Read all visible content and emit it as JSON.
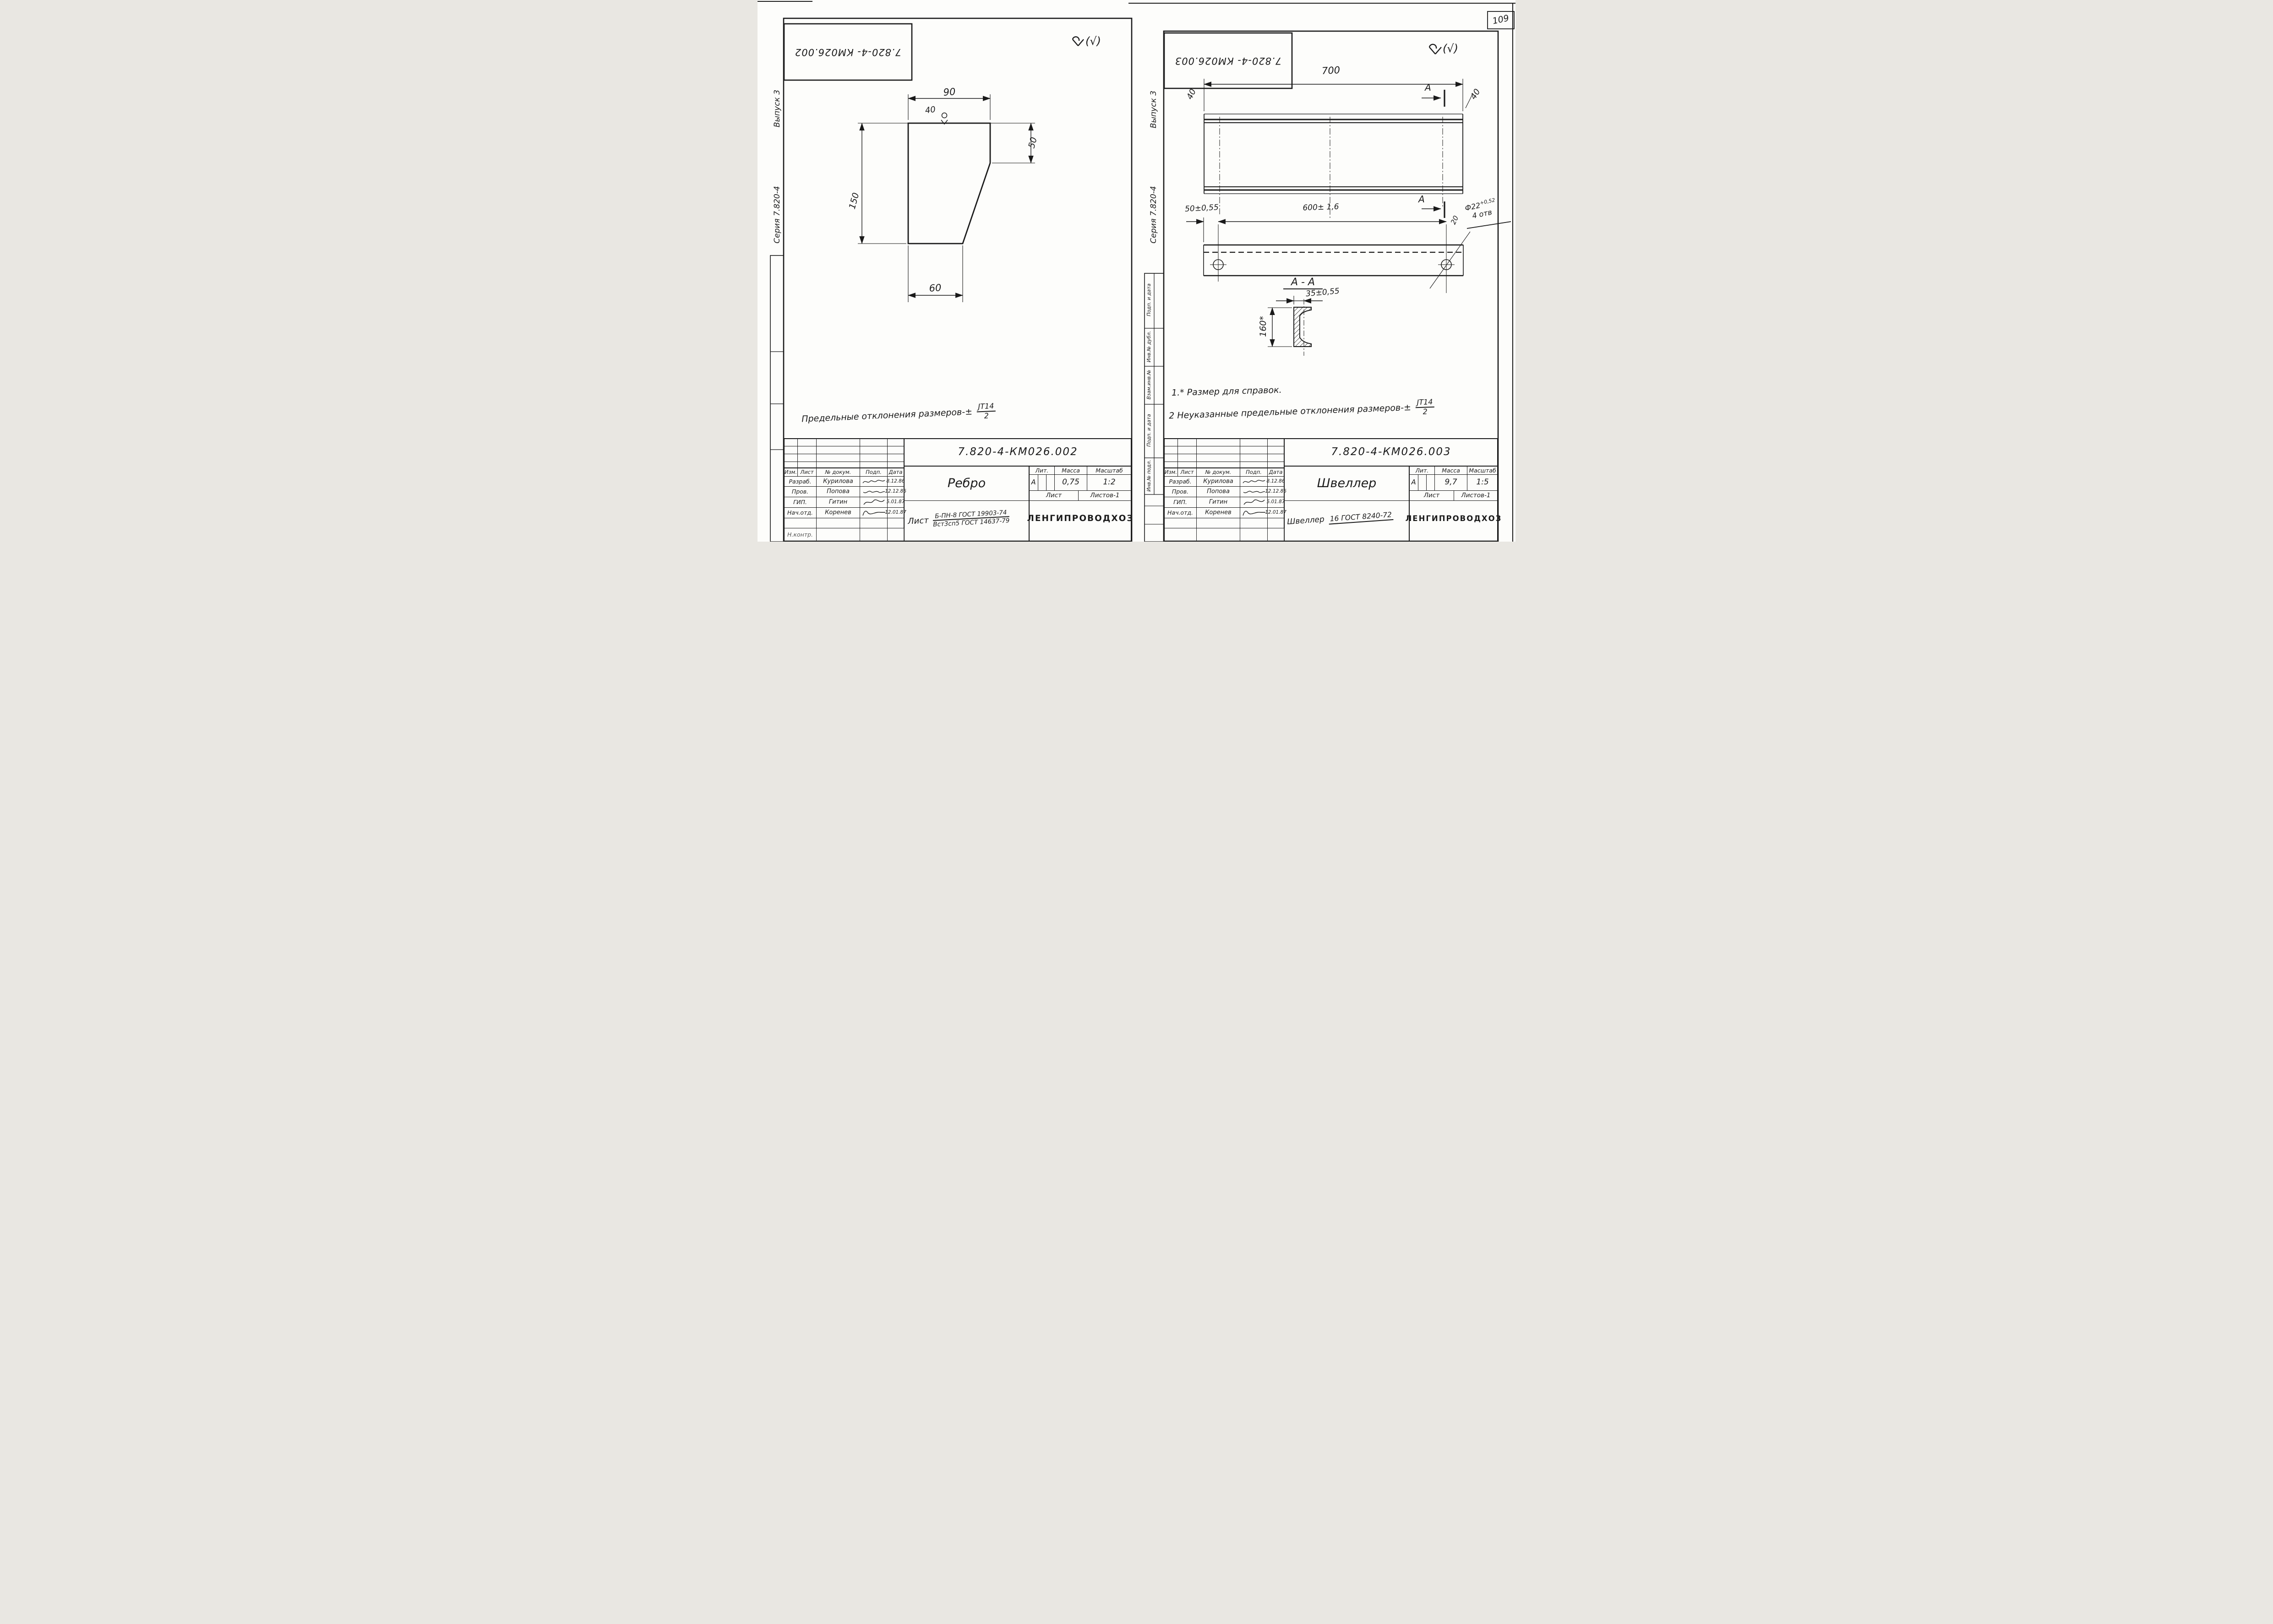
{
  "page": {
    "number": "109"
  },
  "shared": {
    "margin_series": "Серия 7.820-4",
    "margin_issue": "Выпуск 3",
    "roughness_suffix": "(√)",
    "tolerance_frac_top": "JT14",
    "tolerance_frac_bottom": "2",
    "header_cells": [
      "Изм.",
      "Лист",
      "№ докум.",
      "Подп.",
      "Дата"
    ],
    "approval_rows": [
      {
        "role": "Разраб.",
        "name": "Курилова",
        "date": "8.12.86"
      },
      {
        "role": "Пров.",
        "name": "Попова",
        "date": "12.12.86"
      },
      {
        "role": "ГИП.",
        "name": "Гитин",
        "date": "5.01.87"
      },
      {
        "role": "Нач.отд.",
        "name": "Коренев",
        "date": "12.01.87"
      }
    ],
    "partial_row_role": "Н.контр.",
    "lit_label": "Лит.",
    "mass_label": "Масса",
    "scale_label": "Масштаб",
    "sheet_label": "Лист",
    "sheets_label": "Листов-1",
    "lit_value": "А",
    "org": "ЛЕНГИПРОВОДХОЗ",
    "side_labels": [
      "Подп. и дата",
      "Инв.№ дубл.",
      "Взам.инв.№",
      "Подп. и дата",
      "Инв.№ подл."
    ]
  },
  "left": {
    "stamp_code": "7.820-4- КМ026.002",
    "doc_number": "7.820-4-КМ026.002",
    "part_name": "Ребро",
    "mass_value": "0,75",
    "scale_value": "1:2",
    "material_prefix": "Лист",
    "material_top": "Б-ПН-8 ГОСТ 19903-74",
    "material_bottom": "Вст3сп5 ГОСТ 14637-79",
    "note_text": "Предельные отклонения размеров-±",
    "dims": {
      "top": "90",
      "mark": "40",
      "right": "50",
      "left": "150",
      "bottom": "60"
    }
  },
  "right": {
    "stamp_code": "7.820-4- КМ026.003",
    "doc_number": "7.820-4-КМ026.003",
    "part_name": "Швеллер",
    "mass_value": "9,7",
    "scale_value": "1:5",
    "material_prefix": "Швеллер",
    "material_value": "16 ГОСТ 8240-72",
    "note1": "1.* Размер для справок.",
    "note2": "2  Неуказанные предельные отклонения размеров-±",
    "dims": {
      "length": "700",
      "w_left": "40",
      "w_right": "40",
      "section": "А",
      "section_title": "А - А",
      "hole_offset": "50±0,55",
      "hole_spacing": "600± 1,6",
      "hole_dia": "Ф22",
      "hole_tol": "+0,52",
      "hole_count": "4 отв",
      "hole_angle": "20",
      "flange": "35±0,55",
      "height": "160*"
    }
  }
}
